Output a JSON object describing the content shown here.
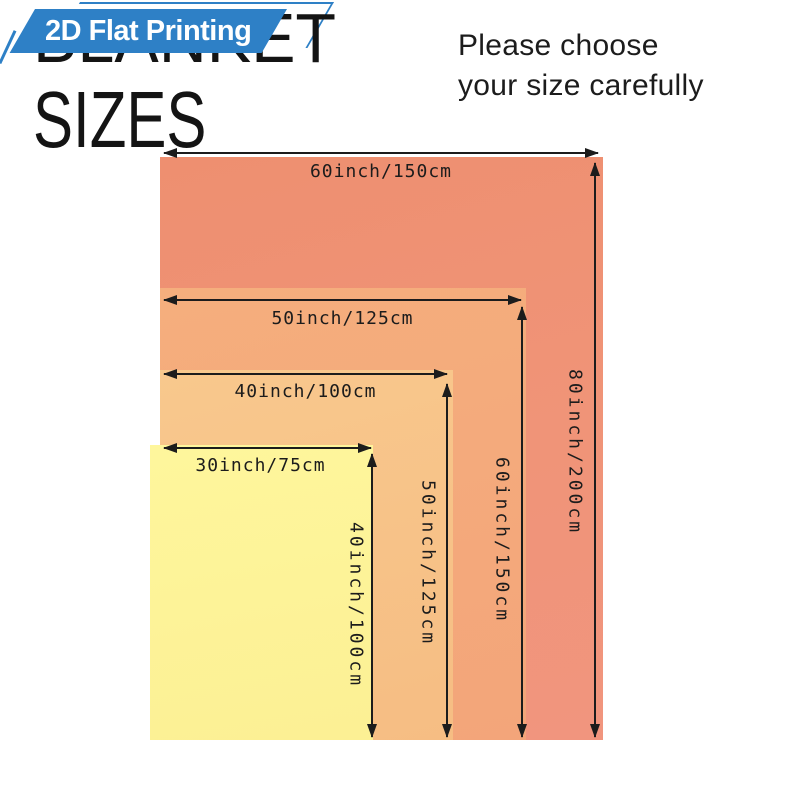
{
  "badge": {
    "label": "2D Flat Printing",
    "color": "#2e80c6"
  },
  "title": {
    "blanket": "BLANKET",
    "sizes": "SIZES"
  },
  "note": {
    "line1": "Please choose",
    "line2": "your size carefully"
  },
  "sizes": [
    {
      "name": "blanket-60x80-inch",
      "width_label": "60inch/150cm",
      "height_label": "80inch/200cm",
      "fill": "#f09478"
    },
    {
      "name": "blanket-50x60-inch",
      "width_label": "50inch/125cm",
      "height_label": "60inch/150cm",
      "fill": "#f4ab7c"
    },
    {
      "name": "blanket-40x50-inch",
      "width_label": "40inch/100cm",
      "height_label": "50inch/125cm",
      "fill": "#f8c78c"
    },
    {
      "name": "blanket-30x40-inch",
      "width_label": "30inch/75cm",
      "height_label": "40inch/100cm",
      "fill": "#fdf49a"
    }
  ],
  "arrow_color": "#1c1c1c"
}
